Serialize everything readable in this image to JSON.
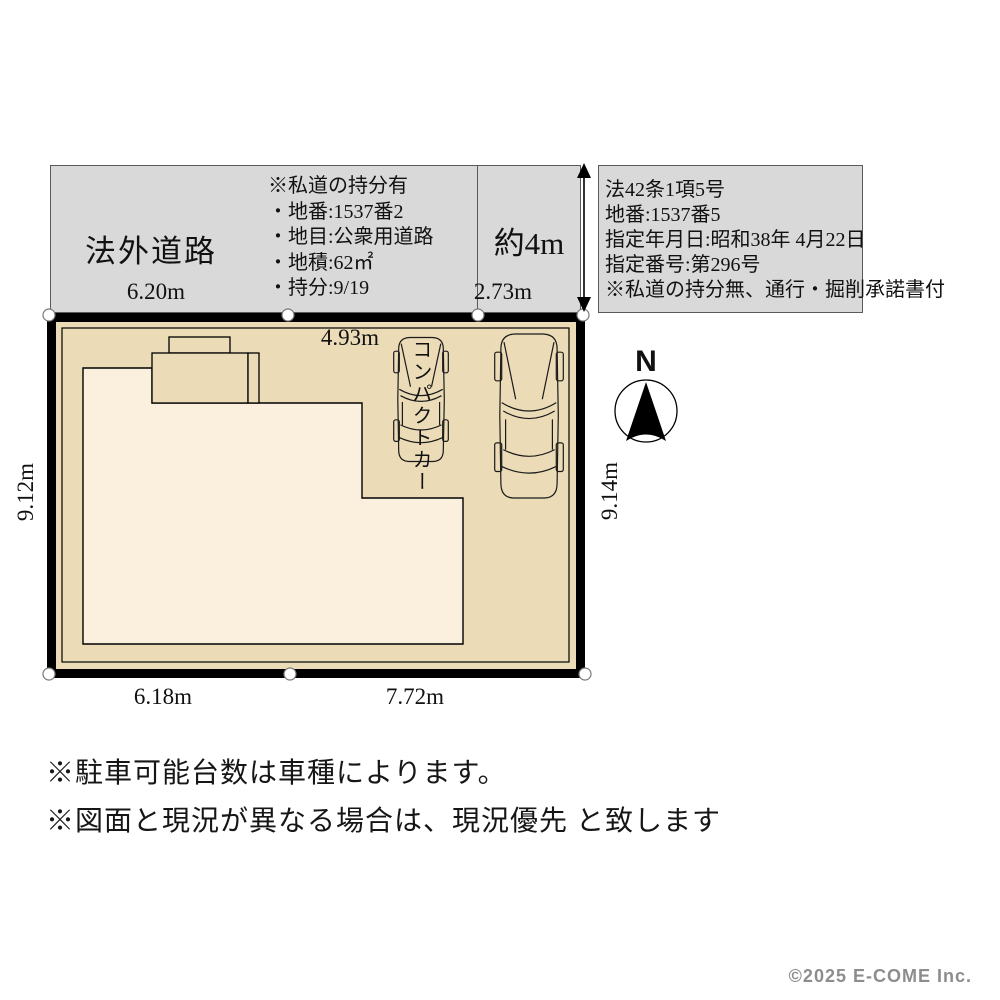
{
  "road_band": {
    "left": {
      "name_label": "法外道路",
      "width_label": "6.20m",
      "notes": [
        "※私道の持分有",
        "・地番:1537番2",
        "・地目:公衆用道路",
        "・地積:62㎡",
        "・持分:9/19"
      ]
    },
    "middle": {
      "approx_label": "約4m",
      "width_label": "2.73m"
    },
    "right": {
      "lines": [
        "法42条1項5号",
        "地番:1537番5",
        "指定年月日:昭和38年 4月22日",
        "指定番号:第296号",
        "※私道の持分無、通行・掘削承諾書付"
      ]
    }
  },
  "lot": {
    "top_edge_label": "4.93m",
    "bottom_edge_labels": [
      "6.18m",
      "7.72m"
    ],
    "left_edge_label": "9.12m",
    "right_edge_label": "9.14m",
    "car_type_label": "コンパクトカー"
  },
  "compass": {
    "north_label": "N"
  },
  "footer_notes": [
    "※駐車可能台数は車種によります。",
    "※図面と現況が異なる場合は、現況優先 と致します"
  ],
  "copyright": "©2025  E-COME Inc.",
  "colors": {
    "road_gray": "#d9d9d9",
    "lot_tan": "#ecdbb7",
    "building_cream": "#fbf0de",
    "outline_black": "#000000",
    "copyright_gray": "#8d8d8d"
  }
}
